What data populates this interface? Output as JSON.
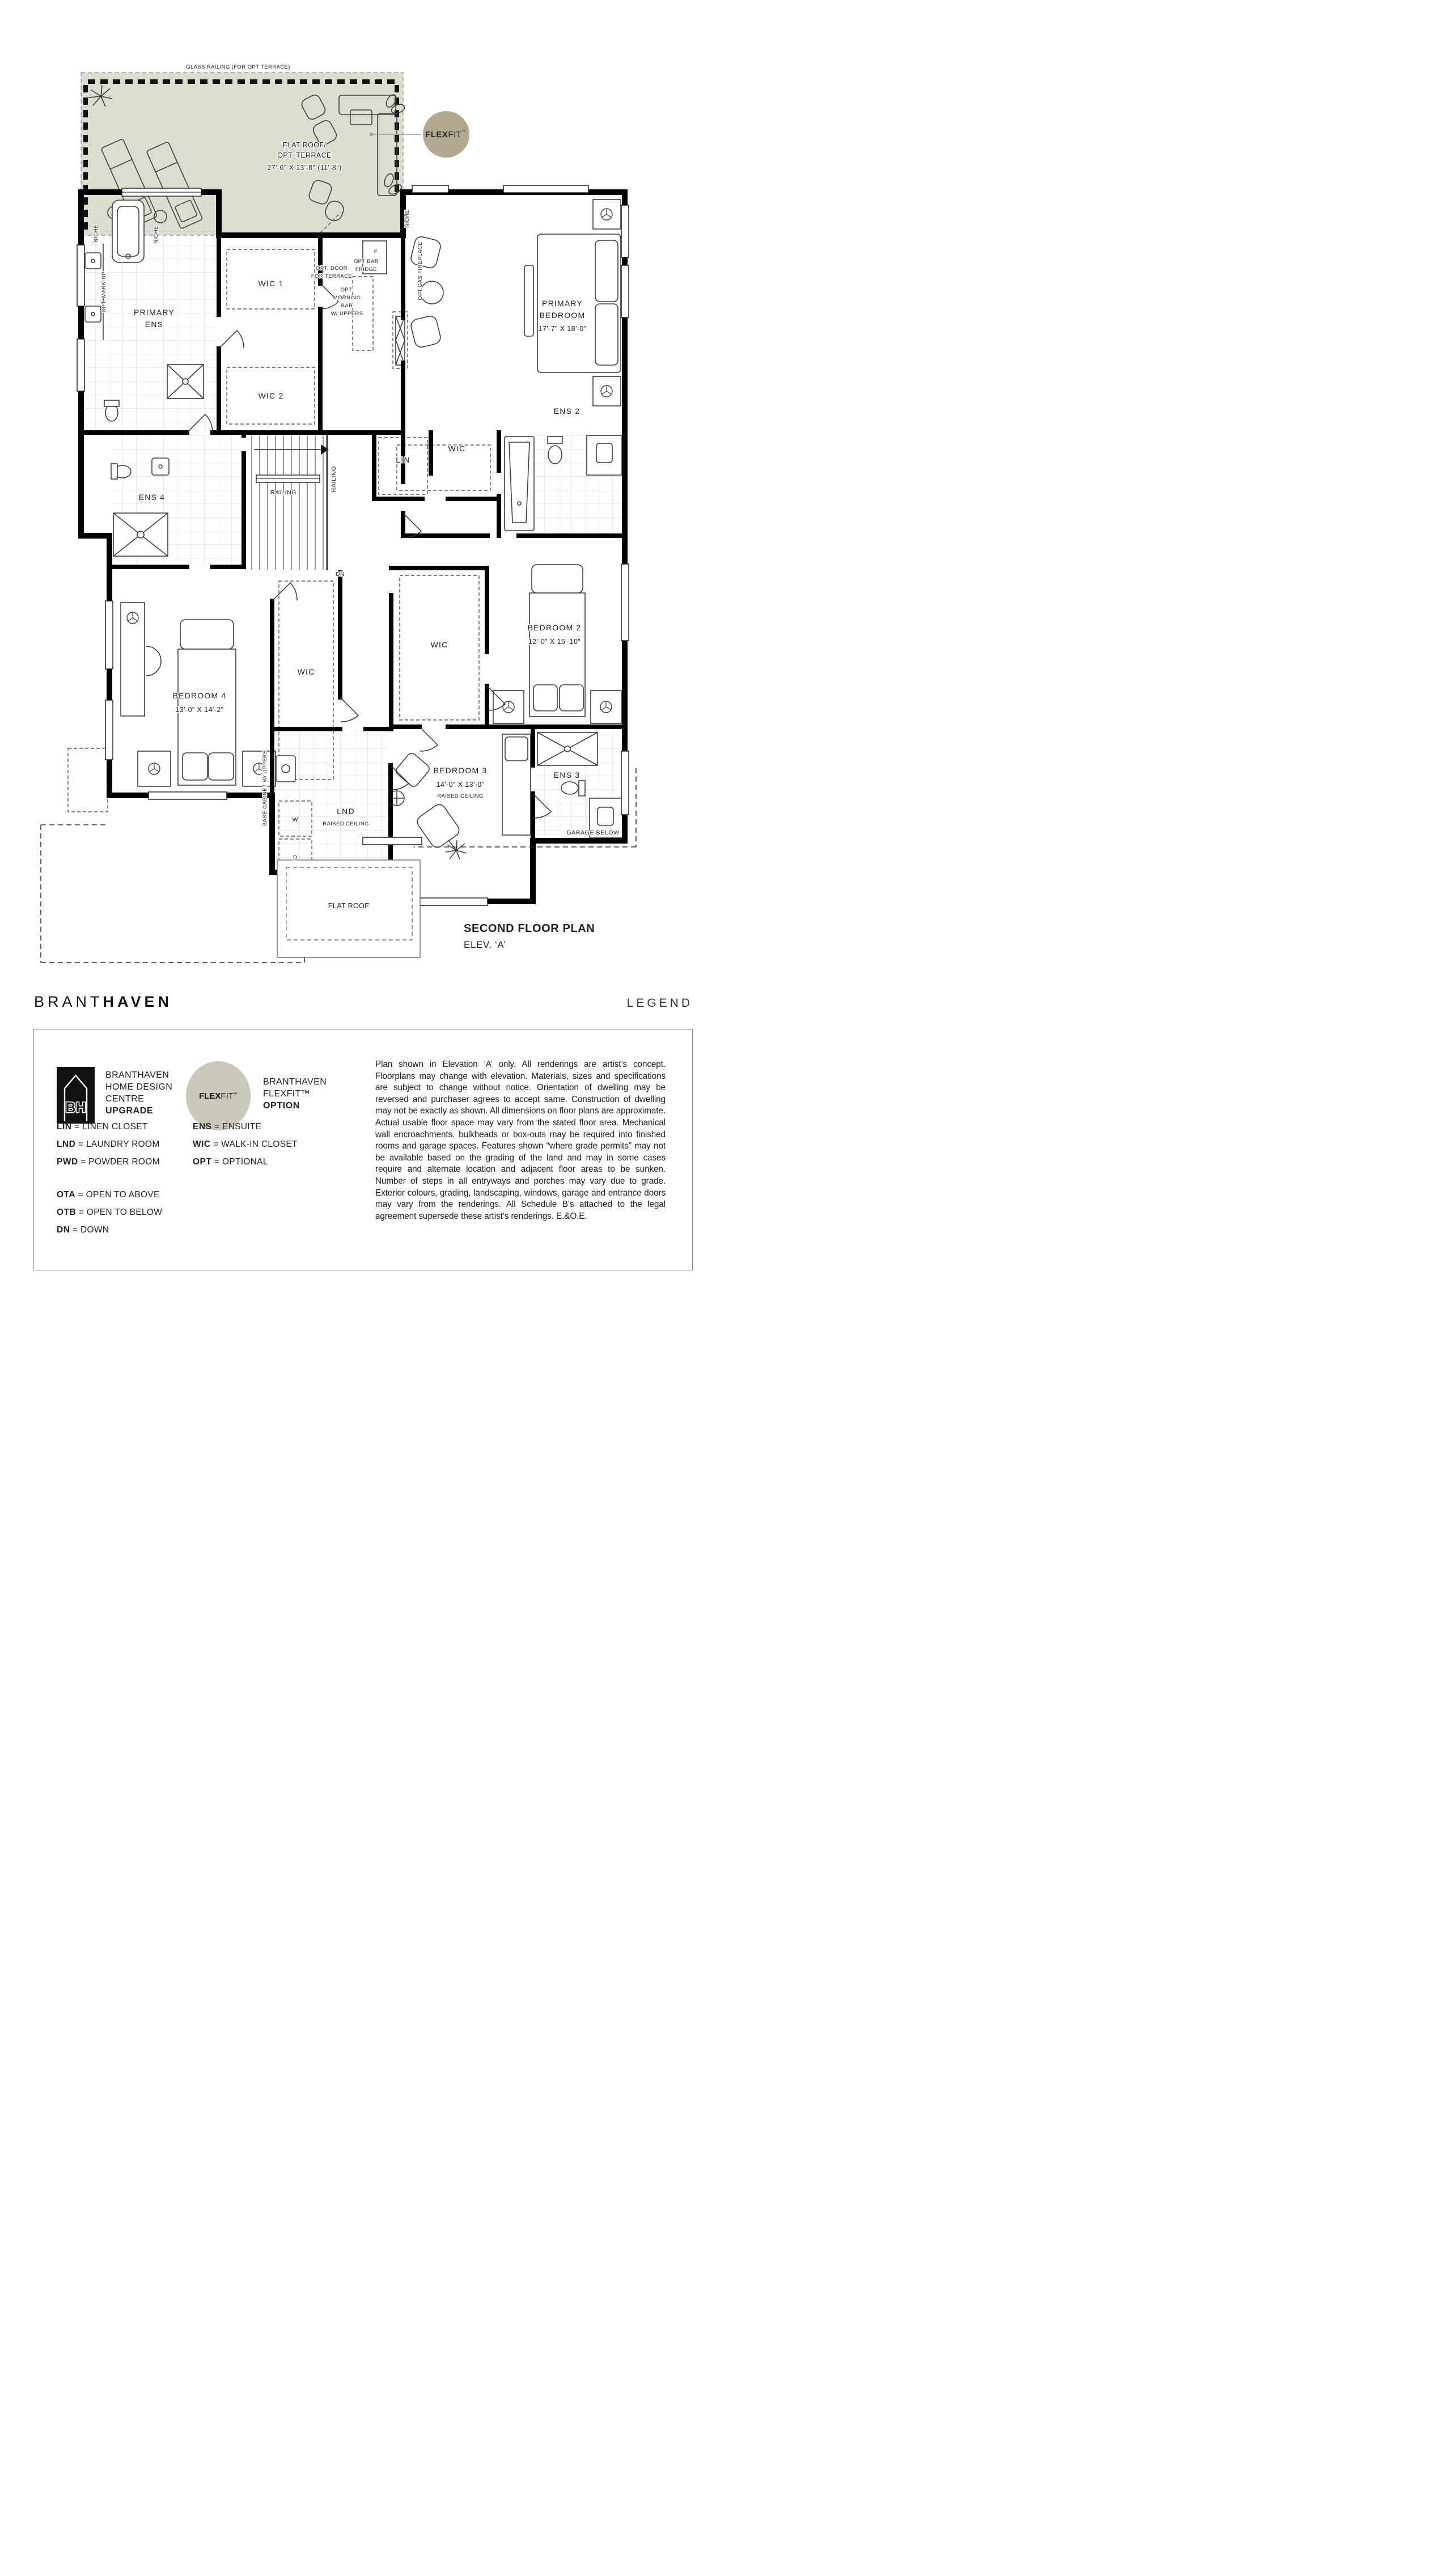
{
  "colors": {
    "terrace_fill": "#dcdcd0",
    "flexfit_badge": "#b2aa8f",
    "flexfit_legend_badge": "#cac8ba",
    "wall": "#000000"
  },
  "terrace": {
    "railing_label": "GLASS RAILING (FOR OPT TERRACE)",
    "line1": "FLAT ROOF/",
    "line2": "OPT. TERRACE",
    "dims": "27'-6\" X 13'-8\" (11'-8\")"
  },
  "flexfit_badge": {
    "bold": "FLEX",
    "light": "FIT",
    "tm": "™"
  },
  "rooms": {
    "primary_ens1": "PRIMARY",
    "primary_ens2": "ENS",
    "wic1": "WIC 1",
    "wic2": "WIC 2",
    "primary_bed1": "PRIMARY",
    "primary_bed2": "BEDROOM",
    "primary_bed_dims": "17'-7\" X 18'-0\"",
    "ens4": "ENS 4",
    "lin": "LIN",
    "wic_hall": "WIC",
    "ens2": "ENS 2",
    "bedroom4": "BEDROOM 4",
    "bedroom4_dims": "13'-0\" X 14'-2\"",
    "wic_bedroom4": "WIC",
    "bedroom2": "BEDROOM 2",
    "bedroom2_dims": "12'-0\" X 15'-10\"",
    "wic_bedroom2": "WIC",
    "bedroom3": "BEDROOM 3",
    "bedroom3_dims": "14'-0\" X 13'-0\"",
    "bedroom3_note": "RAISED CEILING",
    "ens3": "ENS 3",
    "lnd": "LND",
    "lnd_note": "RAISED CEILING"
  },
  "annotations": {
    "niche": "NICHE",
    "opt_markup": "OPT. MARK-UP",
    "opt_door1": "OPT. DOOR",
    "opt_door2": "FOR TERRACE",
    "opt_bar1": "OPT BAR",
    "opt_bar2": "FRIDGE",
    "fridge_f": "F",
    "morning1": "OPT.",
    "morning2": "MORNING",
    "morning3": "BAR",
    "morning4": "W/ UPPERS",
    "gas_fireplace": "OPT.GAS FIREPLACE",
    "railing": "RAILING",
    "dn": "DN",
    "base_cabinet": "BASE CABINET W/ UPPERS",
    "washer": "W",
    "dryer": "D",
    "garage_below": "GARAGE BELOW",
    "living_room_below": "LIVING ROOM  BELOW",
    "flat_roof": "FLAT ROOF"
  },
  "title": {
    "line1": "SECOND FLOOR PLAN",
    "line2": "ELEV. ‘A’"
  },
  "brand": {
    "name_light": "BRANT",
    "name_bold": "HAVEN",
    "legend_heading": "LEGEND"
  },
  "legend": {
    "eq": "=",
    "upgrade": {
      "logo_text": "BH",
      "line1": "BRANTHAVEN",
      "line2": "HOME DESIGN",
      "line3": "CENTRE",
      "line4": "UPGRADE"
    },
    "flexfit": {
      "badge_bold": "FLEX",
      "badge_light": "FIT",
      "badge_tm": "™",
      "line1": "BRANTHAVEN",
      "line2": "FLEXFIT™",
      "line3": "OPTION"
    },
    "col1": [
      {
        "abbr": "LIN",
        "full": "LINEN CLOSET"
      },
      {
        "abbr": "LND",
        "full": "LAUNDRY ROOM"
      },
      {
        "abbr": "PWD",
        "full": "POWDER ROOM"
      }
    ],
    "col2": [
      {
        "abbr": "ENS",
        "full": "ENSUITE"
      },
      {
        "abbr": "WIC",
        "full": "WALK-IN CLOSET"
      },
      {
        "abbr": "OPT",
        "full": "OPTIONAL"
      }
    ],
    "col3": [
      {
        "abbr": "OTA",
        "full": "OPEN TO ABOVE"
      },
      {
        "abbr": "OTB",
        "full": "OPEN TO BELOW"
      },
      {
        "abbr": "DN",
        "full": "DOWN"
      }
    ],
    "disclaimer": "Plan shown in Elevation ‘A’ only. All renderings are artist’s concept. Floorplans may change with elevation. Materials, sizes and specifications are subject to change without notice. Orientation of dwelling may be reversed and purchaser agrees to accept same. Construction of dwelling may not be exactly as shown. All dimensions on floor plans are approximate. Actual usable floor space may vary from the stated floor area. Mechanical wall encroachments, bulkheads or box-outs may be required into finished rooms and garage spaces. Features shown “where grade permits” may not be available based on the grading of the land and may in some cases require and alternate location and adjacent floor areas to be sunken. Number of steps in all entryways and porches may vary due to grade. Exterior colours, grading, landscaping, windows, garage and entrance doors may vary from the renderings. All Schedule B’s attached to the legal agreement supersede these artist’s renderings. E.&O.E."
  }
}
